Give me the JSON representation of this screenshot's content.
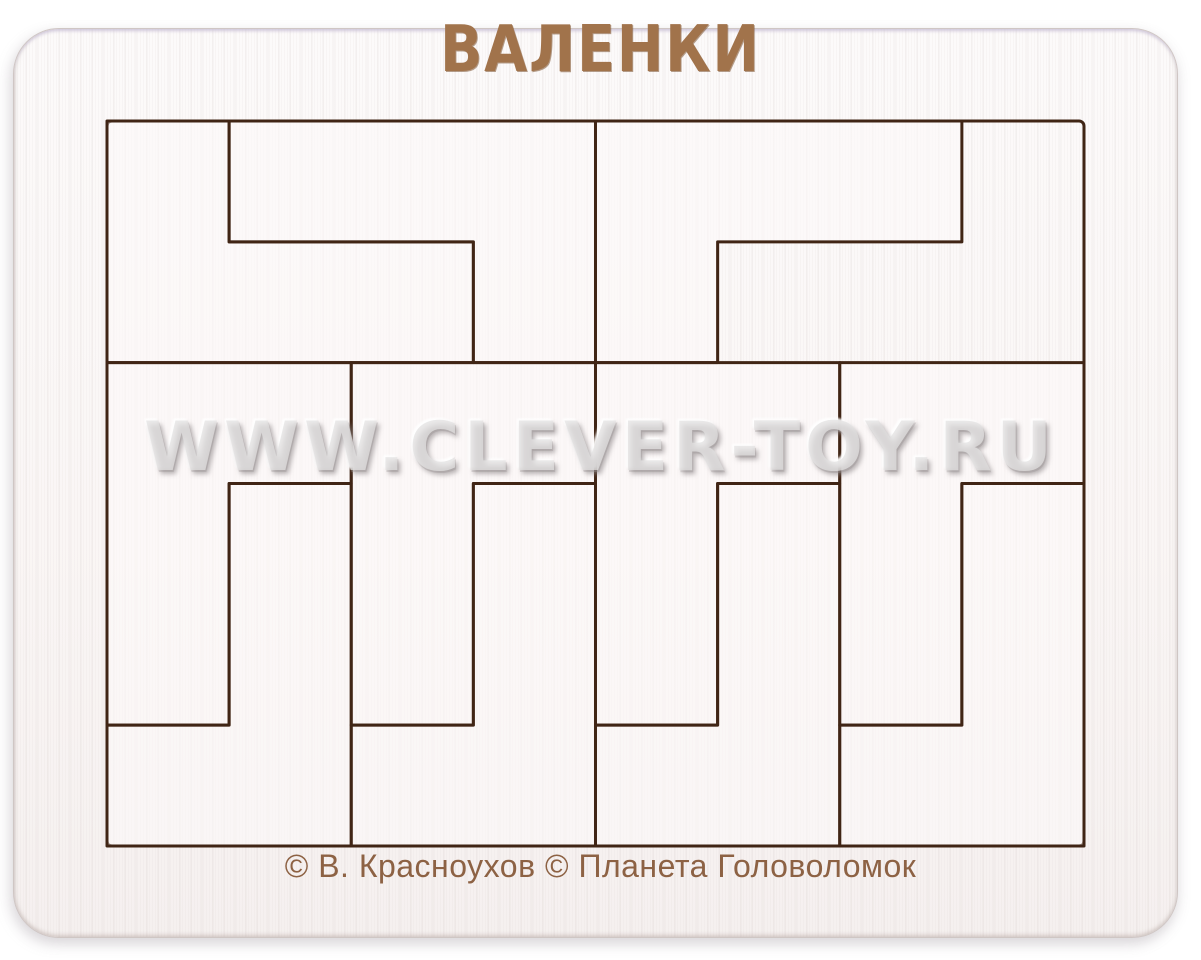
{
  "photo": {
    "background_color": "#ffffff",
    "subject": "wooden tray packing puzzle, product photo"
  },
  "board": {
    "title": "ВАЛЕНКИ",
    "watermark": "WWW.CLEVER-TOY.RU",
    "copyright": "© В. Красноухов © Планета Головоломок",
    "colors": {
      "paint": "#fbf8f7",
      "edge": "#cfc6c4",
      "title_text": "#a1734b",
      "copyright_text": "#8d6244",
      "watermark_text": "rgba(227,225,226,0.75)",
      "cut_line": "#402515",
      "piece_white": "rgba(253,250,249,0.55)",
      "piece_brown": "#bf9069"
    }
  },
  "tray": {
    "x": 107,
    "y": 121,
    "cols": 8,
    "rows": 6,
    "cell_w": 122.125,
    "cell_h": 120.8333,
    "cut_width": 3
  },
  "pieces": [
    {
      "name": "boot-piece-white-top-left-a",
      "material": "white",
      "polygon": [
        [
          0,
          0
        ],
        [
          1,
          0
        ],
        [
          1,
          1
        ],
        [
          3,
          1
        ],
        [
          3,
          2
        ],
        [
          0,
          2
        ]
      ]
    },
    {
      "name": "boot-piece-white-top-left-b",
      "material": "white",
      "polygon": [
        [
          1,
          0
        ],
        [
          4,
          0
        ],
        [
          4,
          2
        ],
        [
          3,
          2
        ],
        [
          3,
          1
        ],
        [
          1,
          1
        ]
      ]
    },
    {
      "name": "boot-piece-white-top-right",
      "material": "white",
      "polygon": [
        [
          4,
          0
        ],
        [
          7,
          0
        ],
        [
          7,
          1
        ],
        [
          5,
          1
        ],
        [
          5,
          2
        ],
        [
          4,
          2
        ]
      ]
    },
    {
      "name": "boot-piece-brown-top-right",
      "material": "brown",
      "polygon": [
        [
          7,
          0
        ],
        [
          8,
          0
        ],
        [
          8,
          2
        ],
        [
          5,
          2
        ],
        [
          5,
          1
        ],
        [
          7,
          1
        ]
      ]
    },
    {
      "name": "boot-piece-white-bottom-1a",
      "material": "white",
      "polygon": [
        [
          0,
          2
        ],
        [
          2,
          2
        ],
        [
          2,
          3
        ],
        [
          1,
          3
        ],
        [
          1,
          5
        ],
        [
          0,
          5
        ]
      ]
    },
    {
      "name": "boot-piece-white-bottom-1b",
      "material": "white",
      "polygon": [
        [
          1,
          3
        ],
        [
          2,
          3
        ],
        [
          2,
          6
        ],
        [
          0,
          6
        ],
        [
          0,
          5
        ],
        [
          1,
          5
        ]
      ]
    },
    {
      "name": "boot-piece-white-bottom-2a",
      "material": "white",
      "polygon": [
        [
          2,
          2
        ],
        [
          4,
          2
        ],
        [
          4,
          3
        ],
        [
          3,
          3
        ],
        [
          3,
          5
        ],
        [
          2,
          5
        ]
      ]
    },
    {
      "name": "boot-piece-white-bottom-2b",
      "material": "white",
      "polygon": [
        [
          3,
          3
        ],
        [
          4,
          3
        ],
        [
          4,
          6
        ],
        [
          2,
          6
        ],
        [
          2,
          5
        ],
        [
          3,
          5
        ]
      ]
    },
    {
      "name": "boot-piece-white-bottom-3a",
      "material": "white",
      "polygon": [
        [
          4,
          2
        ],
        [
          6,
          2
        ],
        [
          6,
          3
        ],
        [
          5,
          3
        ],
        [
          5,
          5
        ],
        [
          4,
          5
        ]
      ]
    },
    {
      "name": "boot-piece-white-bottom-3b",
      "material": "white",
      "polygon": [
        [
          5,
          3
        ],
        [
          6,
          3
        ],
        [
          6,
          6
        ],
        [
          4,
          6
        ],
        [
          4,
          5
        ],
        [
          5,
          5
        ]
      ]
    },
    {
      "name": "boot-piece-white-bottom-4a",
      "material": "white",
      "polygon": [
        [
          6,
          2
        ],
        [
          8,
          2
        ],
        [
          8,
          3
        ],
        [
          7,
          3
        ],
        [
          7,
          5
        ],
        [
          6,
          5
        ]
      ]
    },
    {
      "name": "boot-piece-white-bottom-4b",
      "material": "white",
      "polygon": [
        [
          7,
          3
        ],
        [
          8,
          3
        ],
        [
          8,
          6
        ],
        [
          6,
          6
        ],
        [
          6,
          5
        ],
        [
          7,
          5
        ]
      ]
    }
  ]
}
